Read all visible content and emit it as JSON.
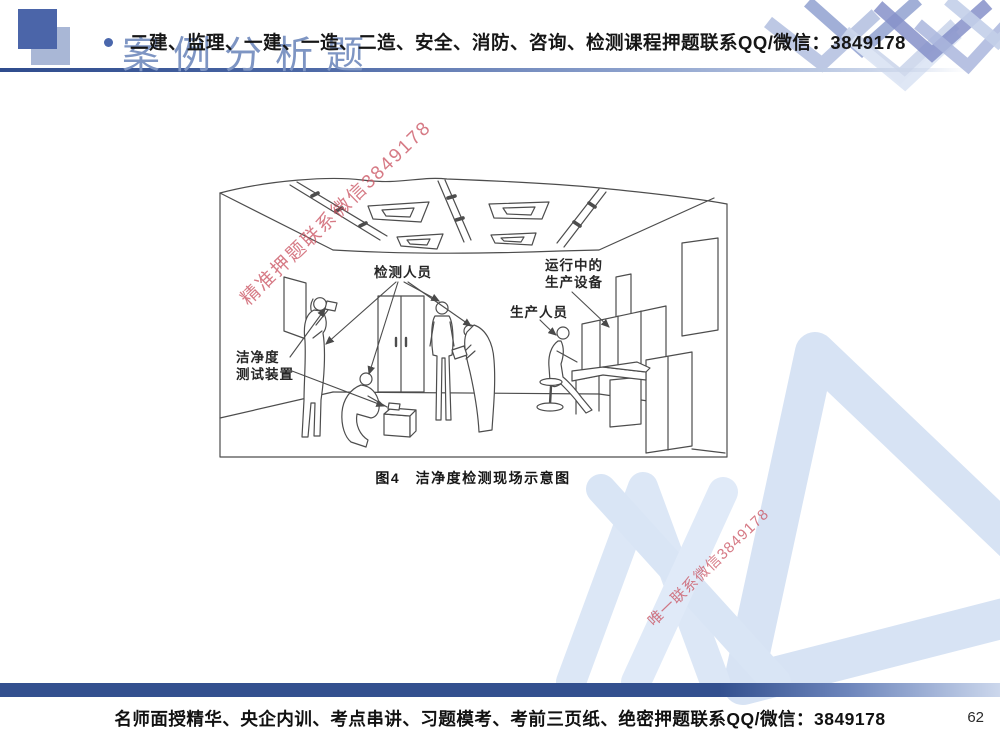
{
  "header": {
    "title": "案例分析题",
    "overlay_text": "二建、监理、一建、一造、二造、安全、消防、咨询、检测课程押题联系QQ/微信：3849178"
  },
  "figure": {
    "caption": "图4　洁净度检测现场示意图",
    "labels": {
      "inspectors": "检测人员",
      "running_equipment_line1": "运行中的",
      "running_equipment_line2": "生产设备",
      "production_staff": "生产人员",
      "cleanliness_device_line1": "洁净度",
      "cleanliness_device_line2": "测试装置"
    }
  },
  "watermarks": {
    "upper_diagonal": "精准押题联系微信3849178",
    "lower_diagonal": "唯一联系微信3849178"
  },
  "footer": {
    "promo_text": "名师面授精华、央企内训、考点串讲、习题模考、考前三页纸、绝密押题联系QQ/微信：3849178",
    "page_number": "62"
  },
  "colors": {
    "accent_square_dark": "#4b65a9",
    "accent_square_light": "#a9b7d6",
    "title_blue": "#7e95c3",
    "watermark_red": "#cb5463",
    "logo_watermark_blue": "#d7e3f4",
    "footer_bar_blue": "#33508f",
    "drawing_stroke": "#4d4d4d"
  }
}
